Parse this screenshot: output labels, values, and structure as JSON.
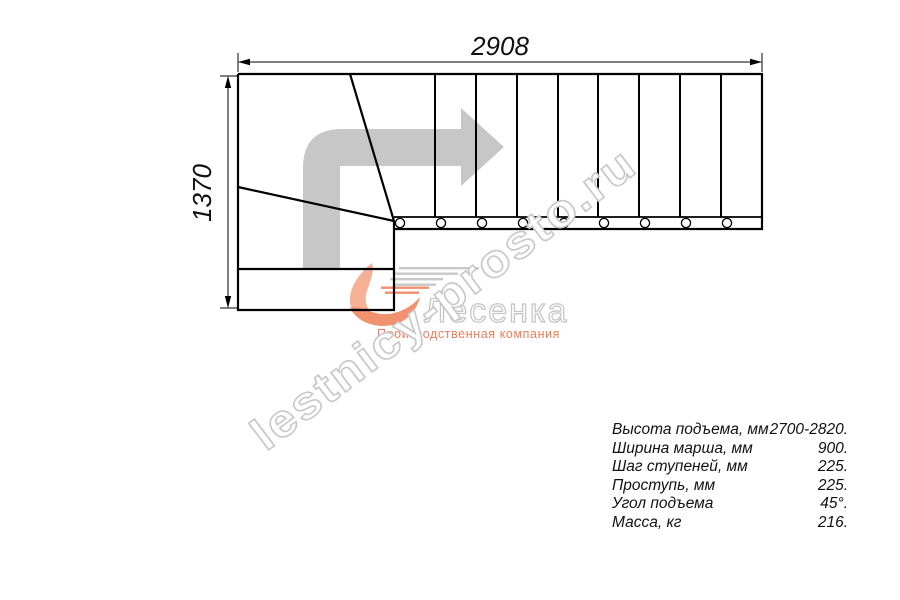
{
  "diagram": {
    "title": "L-shaped staircase plan view",
    "dim_width_label": "2908",
    "dim_height_label": "1370",
    "tread_count_straight": 9,
    "baluster_count": 9,
    "colors": {
      "line": "#000000",
      "direction_arrow": "#c7c7c7"
    }
  },
  "watermark": {
    "text": "lestnicy-prosto.ru",
    "outline_color": "#c9c9c9"
  },
  "logo": {
    "name": "Лесенка",
    "tagline": "Производственная компания",
    "flame_color": "#f0916f",
    "flame_color_light": "#f5b096",
    "accent_color": "#ee7c5a",
    "name_outline_color": "#c6c6c6"
  },
  "specs": {
    "rows": [
      {
        "label": "Высота подъема, мм",
        "value": "2700-2820."
      },
      {
        "label": "Ширина марша, мм",
        "value": "900."
      },
      {
        "label": "Шаг ступеней, мм",
        "value": "225."
      },
      {
        "label": "Проступь, мм",
        "value": "225."
      },
      {
        "label": "Угол подъема",
        "value": "45°."
      },
      {
        "label": "Масса, кг",
        "value": "216."
      }
    ]
  }
}
